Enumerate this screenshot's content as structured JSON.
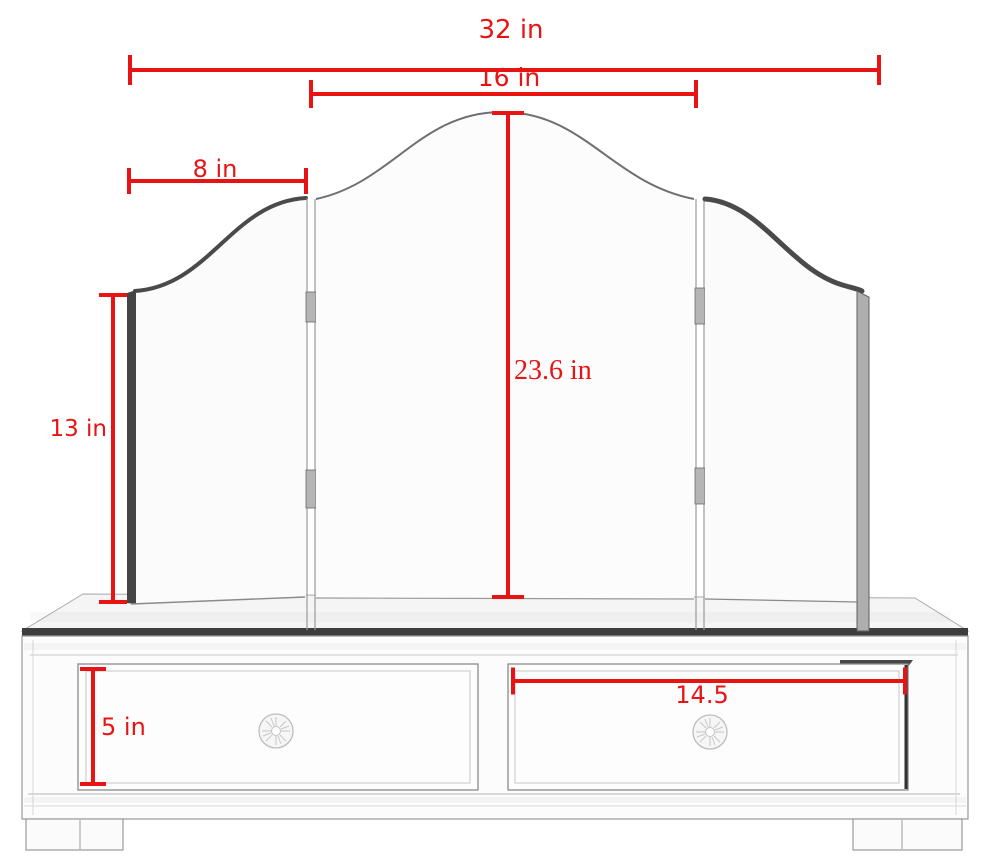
{
  "diagram": {
    "subject": "trifold-vanity-mirror-with-two-drawer-base",
    "colors": {
      "dimension_red": "#e81414",
      "edge_dark": "#454545",
      "line_gray": "#9a9a9a",
      "background": "#ffffff"
    },
    "dimensions": {
      "overall_width": {
        "label": "32 in"
      },
      "center_panel_width": {
        "label": "16 in"
      },
      "side_panel_width": {
        "label": "8 in"
      },
      "side_panel_height": {
        "label": "13 in"
      },
      "overall_height": {
        "label": "23.6 in"
      },
      "drawer_height": {
        "label": "5 in"
      },
      "drawer_width": {
        "label": "14.5"
      }
    }
  }
}
